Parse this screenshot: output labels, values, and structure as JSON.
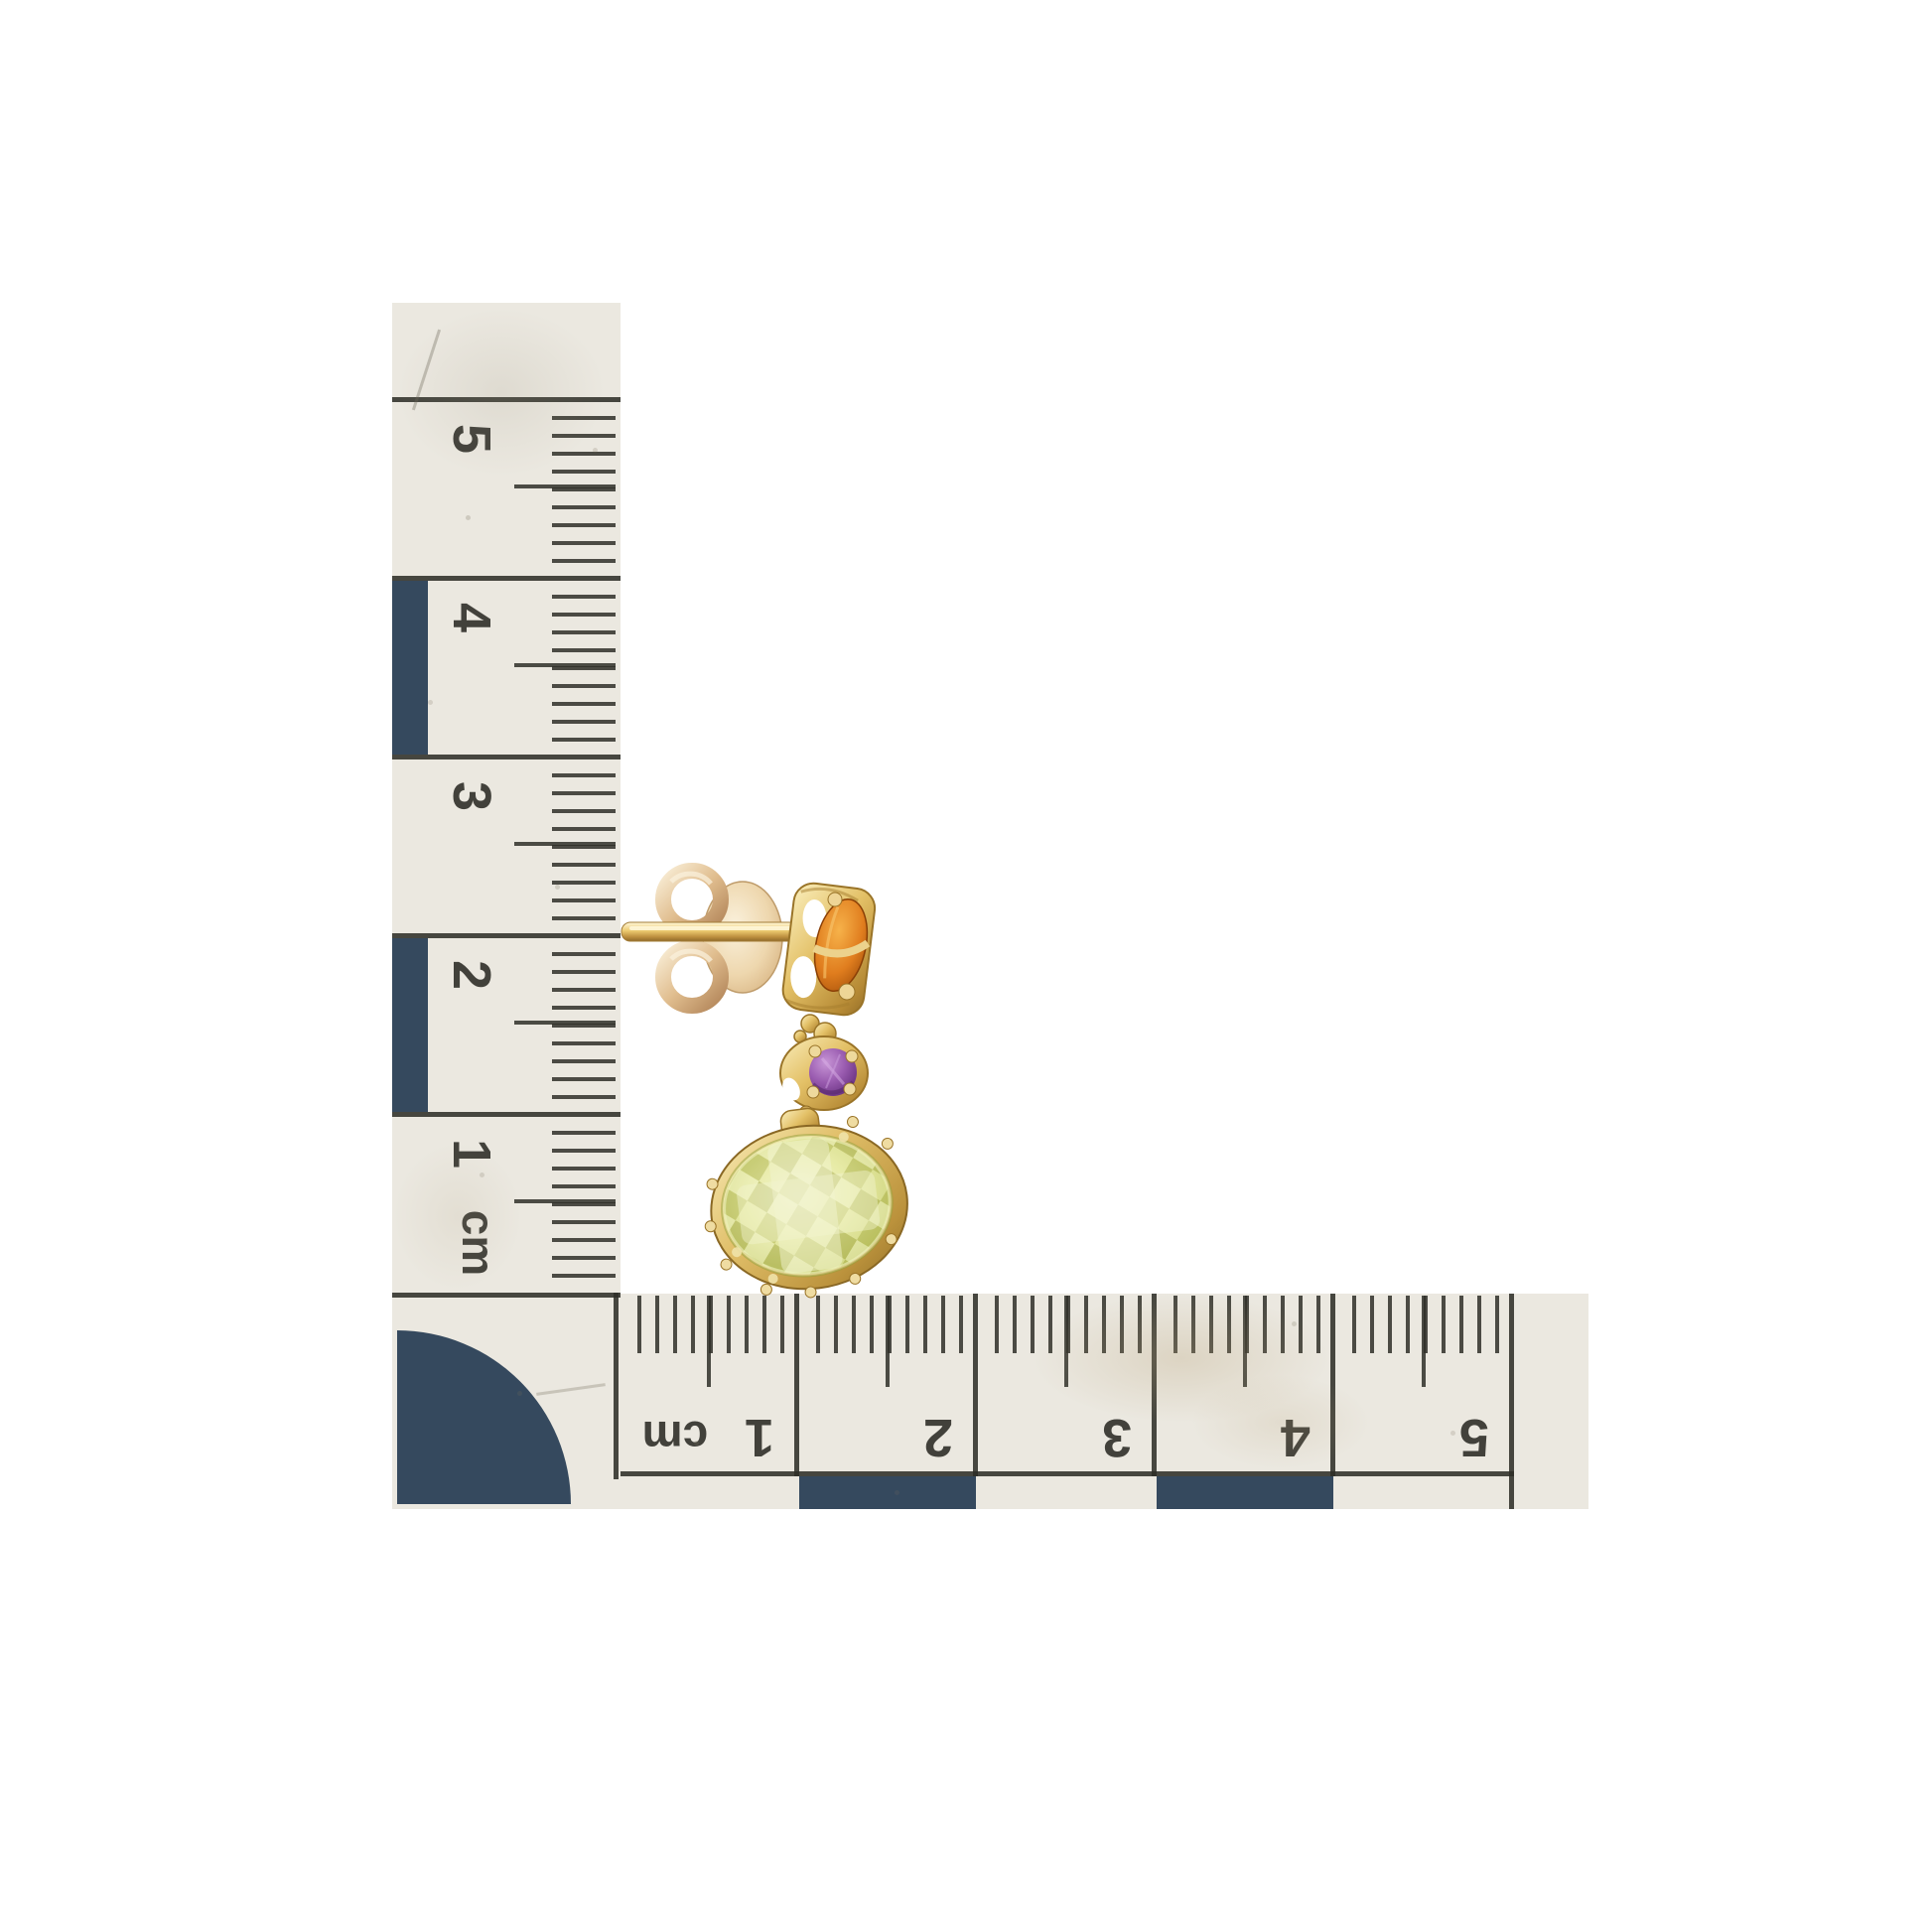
{
  "photo": {
    "type": "jewelry-product-photo",
    "background_color": "#ffffff",
    "subject": "Yellow gold drop earring shown in side profile with butterfly push back, photographed against an L-shaped centimetre scale ruler",
    "earring": {
      "metal_color": "#d4ac55",
      "parts": [
        {
          "name": "butterfly-back",
          "color": "#e0bd8e"
        },
        {
          "name": "post",
          "color": "#ecca70"
        },
        {
          "name": "citrine-stud-stone",
          "color": "#e07d1e"
        },
        {
          "name": "amethyst-middle-stone",
          "color": "#9a5cb0"
        },
        {
          "name": "lemon-quartz-drop-stone",
          "color": "#d9de8a"
        }
      ]
    }
  },
  "rulers": {
    "unit": "cm",
    "paper_color": "#ebe8e0",
    "ink_color": "#32322c",
    "block_color": "#35495e",
    "vertical": {
      "unit_label": "cm",
      "labels": [
        "5",
        "4",
        "3",
        "2",
        "1"
      ]
    },
    "horizontal": {
      "unit_label": "cm",
      "labels": [
        "1",
        "2",
        "3",
        "4",
        "5"
      ]
    }
  }
}
